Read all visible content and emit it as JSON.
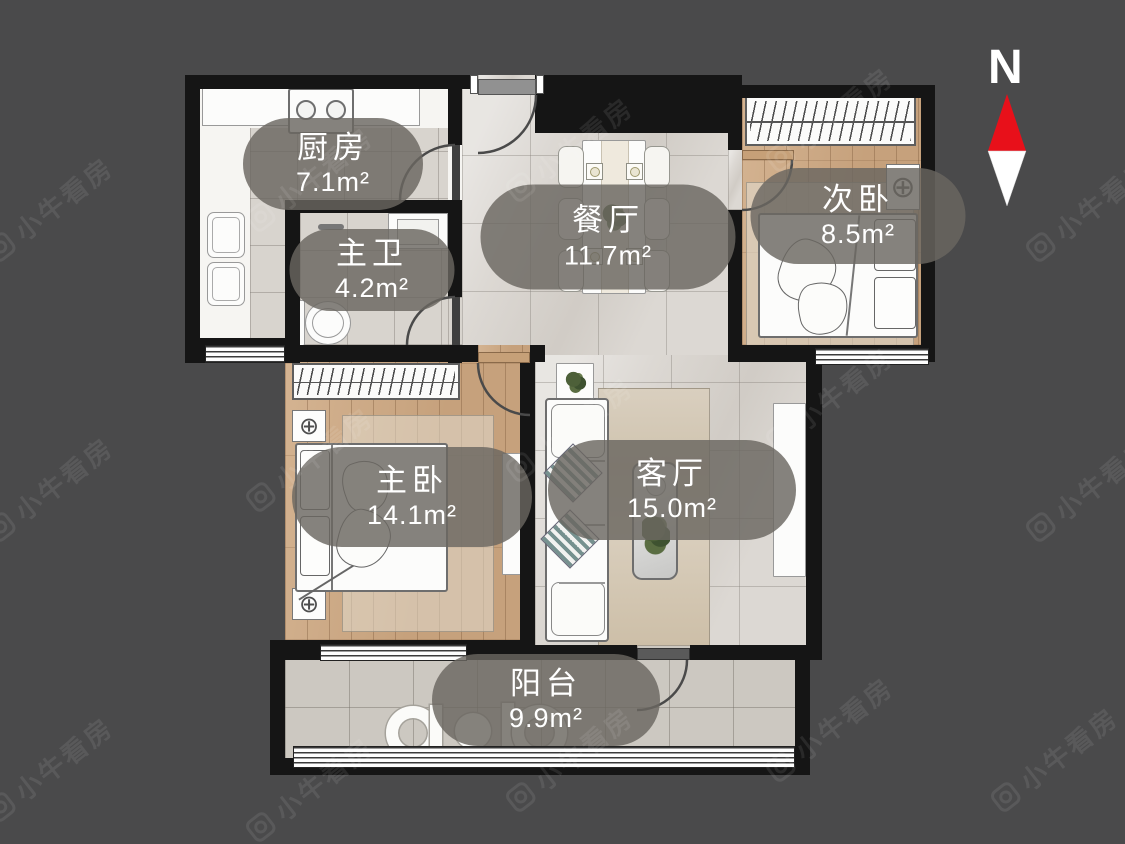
{
  "compass": {
    "label": "N"
  },
  "watermark": {
    "text": "小牛看房"
  },
  "rooms": [
    {
      "id": "kitchen",
      "name": "厨房",
      "area": "7.1m²"
    },
    {
      "id": "master-bath",
      "name": "主卫",
      "area": "4.2m²"
    },
    {
      "id": "dining",
      "name": "餐厅",
      "area": "11.7m²"
    },
    {
      "id": "second-bedroom",
      "name": "次卧",
      "area": "8.5m²"
    },
    {
      "id": "master-bedroom",
      "name": "主卧",
      "area": "14.1m²"
    },
    {
      "id": "living",
      "name": "客厅",
      "area": "15.0m²"
    },
    {
      "id": "balcony",
      "name": "阳台",
      "area": "9.9m²"
    }
  ],
  "colors": {
    "background": "#4a4a4b",
    "wall": "#151515",
    "compass_needle_red": "#e8101a",
    "compass_needle_white": "#ffffff",
    "label_bubble": "rgba(106,102,96,0.82)"
  }
}
